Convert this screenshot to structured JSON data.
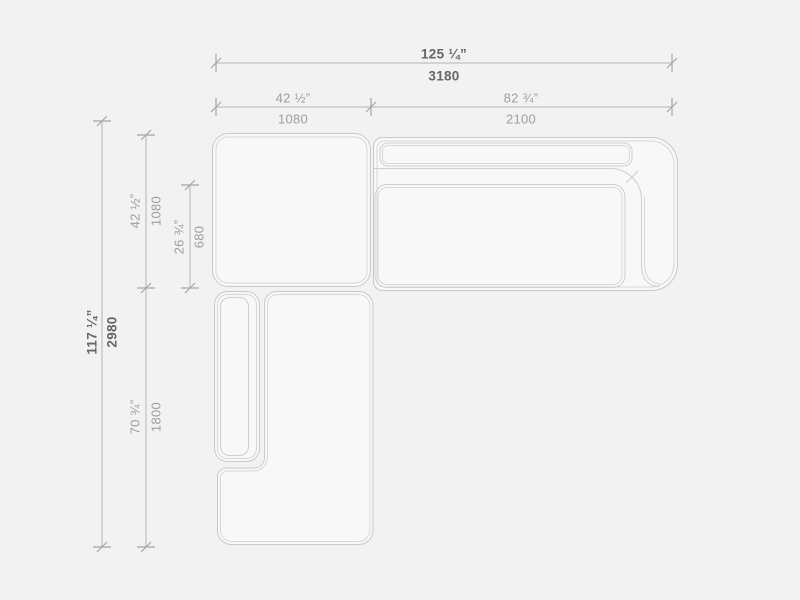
{
  "drawing_type": "sectional-sofa-top-view-dimension-drawing",
  "units": [
    "inches",
    "mm"
  ],
  "colors": {
    "background": "#f2f2f2",
    "module_fill": "#f8f8f8",
    "module_stroke": "#c9c9c9",
    "module_stroke_inner": "#d7d7d7",
    "dimension_line": "#b4b4b4",
    "label_regular": "#9e9e9e",
    "label_bold": "#666666"
  },
  "dimensions": {
    "total_width": {
      "inches": "125 ¼”",
      "mm": "3180"
    },
    "corner_width": {
      "inches": "42 ½”",
      "mm": "1080"
    },
    "sofa_width": {
      "inches": "82 ¾”",
      "mm": "2100"
    },
    "total_depth": {
      "inches": "117 ¼”",
      "mm": "2980"
    },
    "corner_depth": {
      "inches": "42 ½”",
      "mm": "1080"
    },
    "seat_depth": {
      "inches": "26 ¾”",
      "mm": "680"
    },
    "chaise_depth": {
      "inches": "70 ¾”",
      "mm": "1800"
    }
  }
}
